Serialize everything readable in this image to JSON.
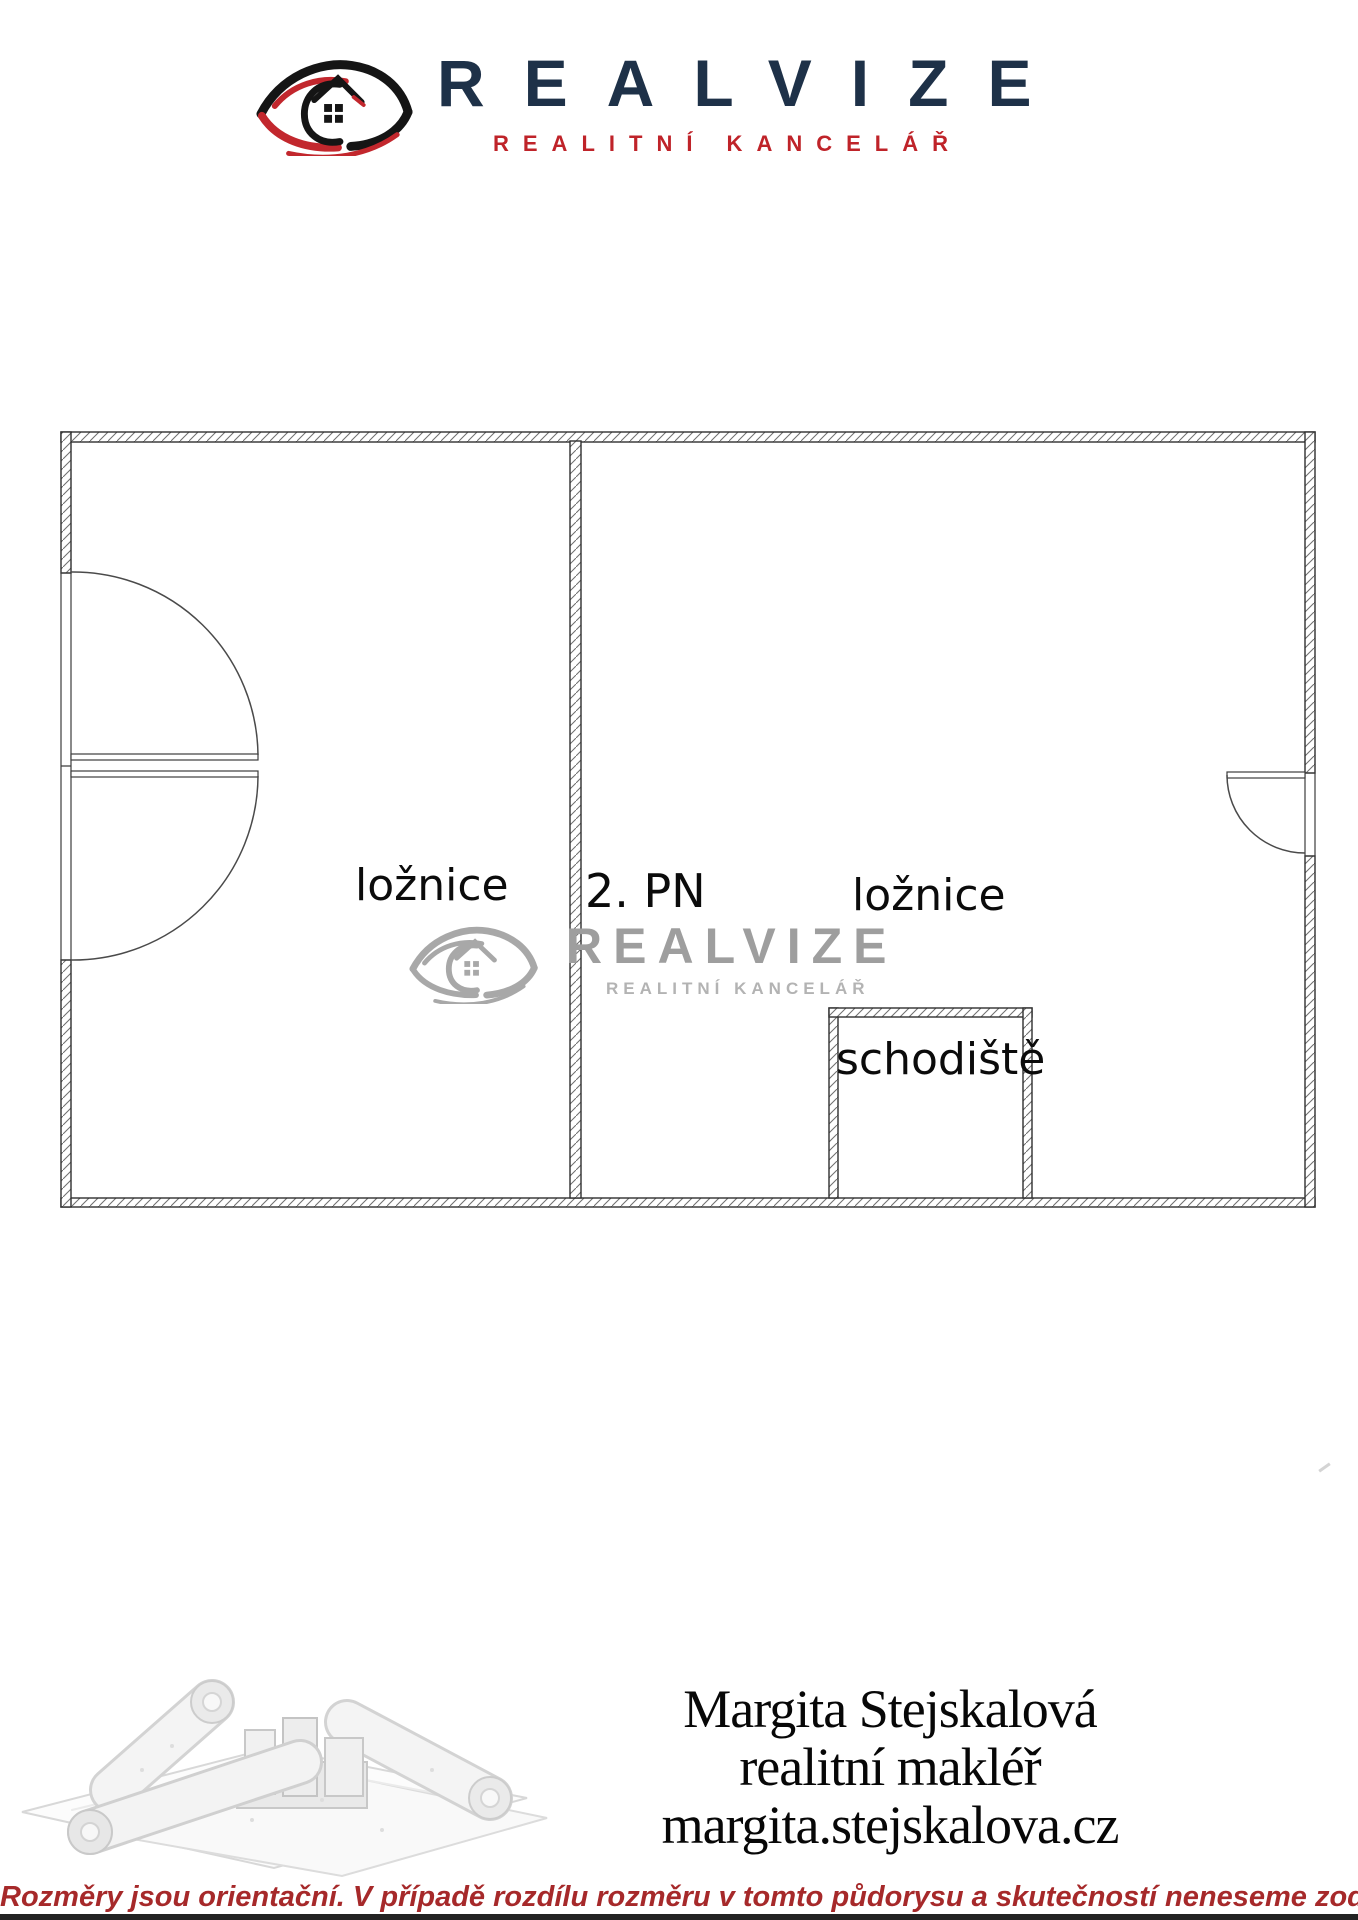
{
  "header": {
    "brand": "REALVIZE",
    "tagline": "REALITNÍ KANCELÁŘ"
  },
  "floor_plan": {
    "floor_label": "2. PN",
    "rooms": [
      {
        "label": "ložnice"
      },
      {
        "label": "ložnice"
      },
      {
        "label": "schodiště"
      }
    ],
    "watermark": {
      "brand": "REALVIZE",
      "tagline": "REALITNÍ KANCELÁŘ"
    }
  },
  "agent": {
    "name": "Margita Stejskalová",
    "role": "realitní makléř",
    "website": "margita.stejskalova.cz"
  },
  "disclaimer": {
    "text": "Rozměry jsou orientační. V případě rozdílu rozměru v tomto půdorysu a skutečností neneseme zodpovědnost"
  },
  "colors": {
    "brand_navy": "#1e3148",
    "brand_red": "#bf2329",
    "disclaimer_red": "#a6292a",
    "watermark_gray": "#9e9e9e",
    "plan_line": "#2f2f2f"
  }
}
